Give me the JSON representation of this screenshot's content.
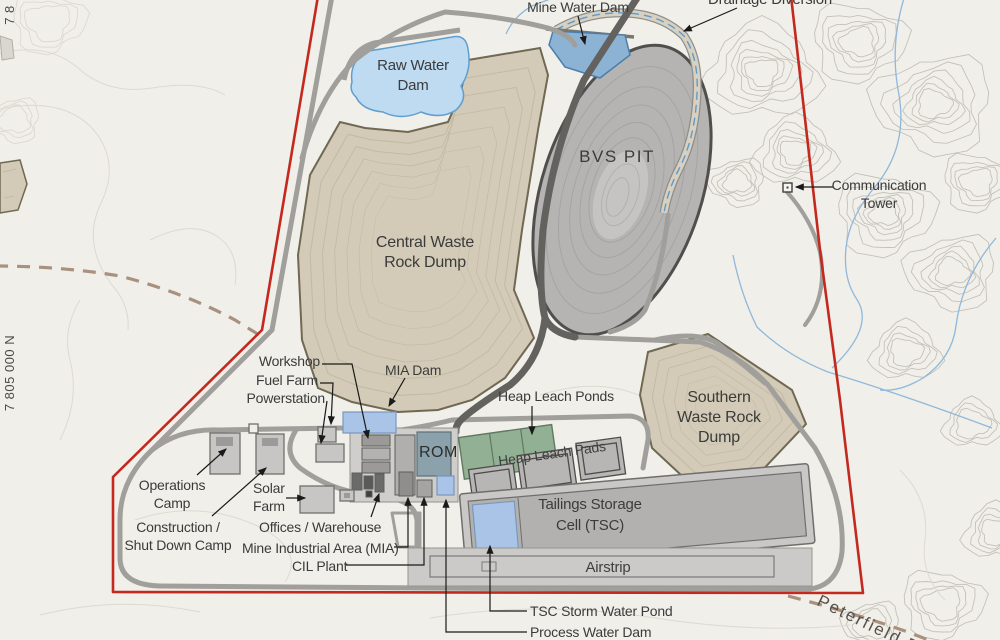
{
  "labels": {
    "mine_water_dam": "Mine Water Dam",
    "drainage_diversion": "Drainage Diversion",
    "raw_water_dam": "Raw Water\nDam",
    "bvs_pit": "BVS PIT",
    "communication_tower": "Communication\nTower",
    "central_waste_rock_dump": "Central Waste\nRock Dump",
    "southern_waste_rock_dump": "Southern\nWaste Rock\nDump",
    "workshop": "Workshop",
    "fuel_farm": "Fuel Farm",
    "powerstation": "Powerstation",
    "mia_dam": "MIA Dam",
    "heap_leach_ponds": "Heap Leach Ponds",
    "heap_leach_pads": "Heap Leach Pads",
    "rom": "ROM",
    "operations_camp": "Operations\nCamp",
    "construction_camp": "Construction /\nShut Down Camp",
    "solar_farm": "Solar\nFarm",
    "offices_warehouse": "Offices / Warehouse",
    "mine_industrial_area": "Mine Industrial Area (MIA)",
    "cil_plant": "CIL Plant",
    "tailings_storage_cell": "Tailings Storage\nCell (TSC)",
    "airstrip": "Airstrip",
    "tsc_storm_water_pond": "TSC Storm Water Pond",
    "process_water_dam": "Process Water Dam",
    "peterfield_road": "Peterfield R",
    "coord_left": "7 805 000 N",
    "coord_top": "7 8"
  },
  "colors": {
    "background": "#f1efe9",
    "boundary_red": "#c3291e",
    "dump_tan_fill": "#d3cbb7",
    "dump_border_olive": "#6f6852",
    "pit_gray": "#b5b4b2",
    "raw_water_blue": "#bedbf2",
    "mine_water_blue": "#8cb2d4",
    "pond_blue": "#a9c4e6",
    "leach_pond_green": "#92b093",
    "rom_pad_blue_gray": "#8ba1ac",
    "road_gray": "#a09f9b",
    "haul_road_dark": "#63625e",
    "track_dashed_brown": "#a8917e",
    "stream_blue": "#8fb8da",
    "label_text": "#3b3b3b"
  }
}
